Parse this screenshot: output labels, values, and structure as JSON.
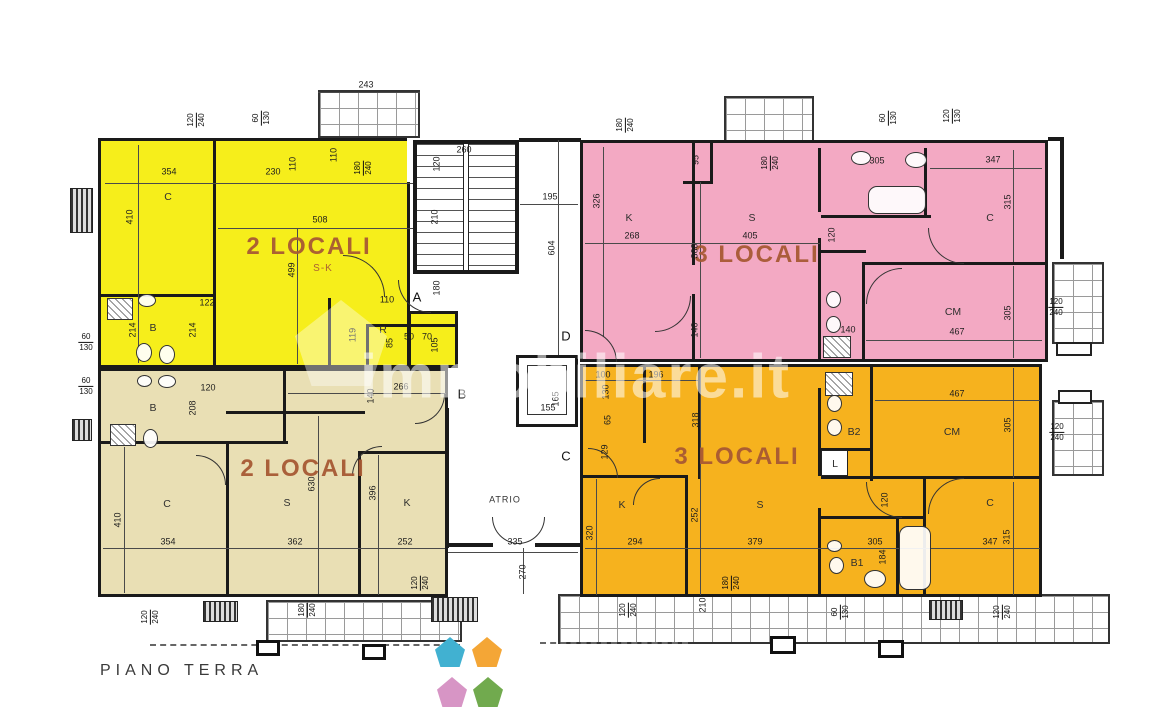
{
  "meta": {
    "floor_label": "PIANO TERRA",
    "watermark_text": "immobiliare.it"
  },
  "palette": {
    "yellow": "#f6ee1b",
    "pink": "#f3a9c3",
    "beige": "#e9dfb4",
    "orange": "#f6b21e",
    "wall": "#1a1a1a",
    "apt_text": "#a75834"
  },
  "apartments": [
    {
      "id": "apt-nw",
      "label": "2 LOCALI",
      "sublabel": "S-K",
      "color": "yellow"
    },
    {
      "id": "apt-ne",
      "label": "3 LOCALI",
      "color": "pink"
    },
    {
      "id": "apt-sw",
      "label": "2 LOCALI",
      "color": "beige"
    },
    {
      "id": "apt-se",
      "label": "3 LOCALI",
      "color": "orange"
    }
  ],
  "outlines": [
    [
      98,
      138,
      312,
      230
    ],
    [
      408,
      311,
      50,
      57
    ],
    [
      580,
      140,
      468,
      222
    ],
    [
      98,
      368,
      350,
      229
    ],
    [
      580,
      364,
      462,
      233
    ],
    [
      413,
      140,
      106,
      134
    ],
    [
      516,
      355,
      62,
      72
    ]
  ],
  "roomfills": [
    {
      "c": "yellow",
      "r": [
        101,
        141,
        306,
        224
      ]
    },
    {
      "c": "yellow",
      "r": [
        411,
        314,
        44,
        51
      ]
    },
    {
      "c": "pink",
      "r": [
        583,
        143,
        462,
        216
      ]
    },
    {
      "c": "beige",
      "r": [
        101,
        371,
        344,
        223
      ]
    },
    {
      "c": "orange",
      "r": [
        583,
        367,
        456,
        227
      ]
    }
  ],
  "whiteboxes": [
    [
      407,
      138,
      52,
      44
    ],
    [
      527,
      365,
      40,
      50
    ]
  ],
  "walls": [
    [
      213,
      141,
      3,
      157
    ],
    [
      101,
      294,
      114,
      3
    ],
    [
      213,
      294,
      3,
      74
    ],
    [
      328,
      298,
      3,
      70
    ],
    [
      366,
      324,
      92,
      3
    ],
    [
      366,
      324,
      3,
      44
    ],
    [
      692,
      143,
      3,
      122
    ],
    [
      692,
      294,
      3,
      66
    ],
    [
      710,
      143,
      3,
      40
    ],
    [
      683,
      181,
      30,
      3
    ],
    [
      818,
      148,
      3,
      64
    ],
    [
      818,
      238,
      3,
      122
    ],
    [
      821,
      215,
      110,
      3
    ],
    [
      924,
      148,
      3,
      70
    ],
    [
      864,
      262,
      181,
      3
    ],
    [
      862,
      262,
      3,
      98
    ],
    [
      821,
      250,
      45,
      3
    ],
    [
      101,
      441,
      187,
      3
    ],
    [
      283,
      371,
      3,
      73
    ],
    [
      226,
      443,
      3,
      152
    ],
    [
      226,
      411,
      139,
      3
    ],
    [
      358,
      451,
      3,
      144
    ],
    [
      358,
      451,
      90,
      3
    ],
    [
      445,
      408,
      4,
      140
    ],
    [
      445,
      543,
      48,
      4
    ],
    [
      535,
      543,
      47,
      4
    ],
    [
      643,
      367,
      3,
      76
    ],
    [
      698,
      367,
      3,
      112
    ],
    [
      583,
      475,
      105,
      3
    ],
    [
      685,
      477,
      3,
      120
    ],
    [
      818,
      388,
      3,
      88
    ],
    [
      818,
      508,
      3,
      89
    ],
    [
      870,
      367,
      3,
      114
    ],
    [
      821,
      476,
      221,
      3
    ],
    [
      923,
      479,
      3,
      118
    ],
    [
      821,
      516,
      104,
      3
    ],
    [
      821,
      448,
      51,
      3
    ],
    [
      896,
      519,
      3,
      78
    ],
    [
      519,
      138,
      62,
      4
    ],
    [
      1048,
      137,
      16,
      4
    ],
    [
      1060,
      137,
      4,
      122
    ]
  ],
  "balconies": [
    [
      318,
      90,
      102,
      48
    ],
    [
      724,
      96,
      90,
      62
    ],
    [
      1052,
      262,
      52,
      82
    ],
    [
      1052,
      400,
      52,
      76
    ],
    [
      266,
      600,
      196,
      42
    ],
    [
      558,
      594,
      552,
      50
    ]
  ],
  "flowerboxes": [
    [
      1056,
      342,
      36,
      14
    ],
    [
      1058,
      390,
      34,
      14
    ]
  ],
  "posts": [
    [
      256,
      640,
      24,
      16
    ],
    [
      362,
      644,
      24,
      16
    ],
    [
      770,
      636,
      26,
      18
    ],
    [
      878,
      640,
      26,
      18
    ]
  ],
  "radiators": [
    [
      70,
      188,
      23,
      45
    ],
    [
      72,
      419,
      20,
      22
    ],
    [
      203,
      601,
      35,
      21
    ],
    [
      431,
      597,
      47,
      25
    ],
    [
      929,
      600,
      34,
      20
    ]
  ],
  "dashes": [
    [
      150,
      644,
      310
    ],
    [
      540,
      642,
      148
    ]
  ],
  "dimlines": [
    [
      318,
      92,
      102,
      1
    ],
    [
      415,
      156,
      102,
      1
    ],
    [
      520,
      204,
      58,
      1
    ],
    [
      105,
      183,
      348,
      1
    ],
    [
      218,
      228,
      240,
      1
    ],
    [
      585,
      243,
      235,
      1
    ],
    [
      930,
      168,
      112,
      1
    ],
    [
      866,
      340,
      176,
      1
    ],
    [
      585,
      380,
      113,
      1
    ],
    [
      875,
      400,
      165,
      1
    ],
    [
      103,
      548,
      342,
      1
    ],
    [
      585,
      548,
      455,
      1
    ],
    [
      448,
      552,
      130,
      1
    ],
    [
      288,
      393,
      158,
      1
    ],
    [
      138,
      145,
      1,
      218
    ],
    [
      297,
      228,
      1,
      136
    ],
    [
      443,
      145,
      1,
      126
    ],
    [
      558,
      140,
      1,
      226
    ],
    [
      603,
      147,
      1,
      190
    ],
    [
      700,
      182,
      1,
      176
    ],
    [
      1013,
      150,
      1,
      112
    ],
    [
      1013,
      266,
      1,
      92
    ],
    [
      124,
      447,
      1,
      146
    ],
    [
      318,
      416,
      1,
      178
    ],
    [
      378,
      455,
      1,
      140
    ],
    [
      596,
      479,
      1,
      116
    ],
    [
      700,
      368,
      1,
      227
    ],
    [
      1013,
      368,
      1,
      110
    ],
    [
      1013,
      482,
      1,
      113
    ],
    [
      523,
      548,
      1,
      46
    ]
  ],
  "stairs": {
    "block": [
      413,
      140,
      106,
      134
    ],
    "stripes": [
      417,
      144,
      98,
      126
    ],
    "divider": [
      463,
      144,
      6,
      126
    ]
  },
  "elevator": {
    "outer": [
      516,
      355,
      62,
      72
    ],
    "inner": [
      527,
      365,
      40,
      50
    ]
  },
  "fixtures": {
    "showers": [
      [
        107,
        298,
        26,
        22
      ],
      [
        110,
        424,
        26,
        22
      ],
      [
        823,
        336,
        28,
        22
      ],
      [
        825,
        372,
        28,
        24
      ]
    ],
    "tubs": [
      [
        868,
        186,
        58,
        28
      ],
      [
        899,
        526,
        32,
        64
      ]
    ],
    "ellipses": [
      [
        138,
        294,
        18,
        13
      ],
      [
        136,
        343,
        16,
        19
      ],
      [
        159,
        345,
        16,
        19
      ],
      [
        137,
        375,
        15,
        12
      ],
      [
        158,
        375,
        18,
        13
      ],
      [
        143,
        429,
        15,
        19
      ],
      [
        851,
        151,
        20,
        14
      ],
      [
        905,
        152,
        22,
        16
      ],
      [
        826,
        291,
        15,
        17
      ],
      [
        826,
        316,
        15,
        17
      ],
      [
        827,
        395,
        15,
        17
      ],
      [
        827,
        419,
        15,
        17
      ],
      [
        827,
        540,
        15,
        12
      ],
      [
        829,
        557,
        15,
        17
      ],
      [
        864,
        570,
        22,
        18
      ]
    ],
    "boxes": [
      [
        821,
        450,
        27,
        26
      ]
    ]
  },
  "doors": [
    [
      343,
      255,
      42,
      "tr"
    ],
    [
      398,
      280,
      33,
      "bl"
    ],
    [
      655,
      296,
      36,
      "br"
    ],
    [
      585,
      330,
      32,
      "tr"
    ],
    [
      928,
      228,
      36,
      "bl"
    ],
    [
      866,
      268,
      36,
      "tl"
    ],
    [
      352,
      446,
      30,
      "tl"
    ],
    [
      196,
      455,
      30,
      "tr"
    ],
    [
      415,
      394,
      30,
      "br"
    ],
    [
      588,
      448,
      30,
      "tr"
    ],
    [
      633,
      478,
      27,
      "tl"
    ],
    [
      866,
      482,
      36,
      "bl"
    ],
    [
      928,
      478,
      36,
      "tl"
    ],
    [
      492,
      517,
      27,
      "bl"
    ],
    [
      518,
      517,
      27,
      "br"
    ]
  ],
  "labels": {
    "apt": [
      [
        "2 LOCALI",
        309,
        247
      ],
      [
        "3 LOCALI",
        757,
        255
      ],
      [
        "2 LOCALI",
        303,
        469
      ],
      [
        "3 LOCALI",
        737,
        457
      ]
    ],
    "sub": [
      [
        "S-K",
        323,
        269
      ]
    ],
    "room": [
      [
        "C",
        168,
        197
      ],
      [
        "B",
        153,
        328
      ],
      [
        "R",
        383,
        330
      ],
      [
        "K",
        629,
        218
      ],
      [
        "S",
        752,
        218
      ],
      [
        "C",
        990,
        218
      ],
      [
        "CM",
        953,
        312
      ],
      [
        "B",
        153,
        408
      ],
      [
        "C",
        167,
        504
      ],
      [
        "S",
        287,
        503
      ],
      [
        "K",
        407,
        503
      ],
      [
        "K",
        622,
        505
      ],
      [
        "S",
        760,
        505
      ],
      [
        "CM",
        952,
        432
      ],
      [
        "C",
        990,
        503
      ],
      [
        "B2",
        854,
        432
      ],
      [
        "B1",
        857,
        563
      ],
      [
        "L",
        835,
        464
      ]
    ],
    "atrio": [
      [
        "ATRIO",
        505,
        500
      ]
    ],
    "letter": [
      [
        "A",
        417,
        297
      ],
      [
        "B",
        462,
        394
      ],
      [
        "C",
        566,
        456
      ],
      [
        "D",
        566,
        336
      ]
    ],
    "dim": [
      [
        "354",
        169,
        172
      ],
      [
        "230",
        273,
        172
      ],
      [
        "508",
        320,
        220
      ],
      [
        "122",
        207,
        303
      ],
      [
        "110",
        387,
        300
      ],
      [
        "50",
        409,
        337
      ],
      [
        "70",
        427,
        337
      ],
      [
        "243",
        366,
        85
      ],
      [
        "260",
        464,
        150
      ],
      [
        "195",
        550,
        197
      ],
      [
        "268",
        632,
        236
      ],
      [
        "405",
        750,
        236
      ],
      [
        "305",
        877,
        161
      ],
      [
        "347",
        993,
        160
      ],
      [
        "467",
        957,
        332
      ],
      [
        "140",
        848,
        330
      ],
      [
        "120",
        208,
        388
      ],
      [
        "266",
        401,
        387
      ],
      [
        "354",
        168,
        542
      ],
      [
        "362",
        295,
        542
      ],
      [
        "252",
        405,
        542
      ],
      [
        "100",
        603,
        375
      ],
      [
        "196",
        656,
        375
      ],
      [
        "294",
        635,
        542
      ],
      [
        "379",
        755,
        542
      ],
      [
        "305",
        875,
        542
      ],
      [
        "467",
        957,
        394
      ],
      [
        "347",
        990,
        542
      ],
      [
        "335",
        515,
        542
      ],
      [
        "155",
        548,
        408
      ]
    ],
    "dimv": [
      [
        "410",
        130,
        217
      ],
      [
        "110",
        293,
        164
      ],
      [
        "110",
        334,
        155
      ],
      [
        "499",
        292,
        270
      ],
      [
        "214",
        133,
        330
      ],
      [
        "214",
        193,
        330
      ],
      [
        "119",
        353,
        335
      ],
      [
        "105",
        435,
        345
      ],
      [
        "85",
        390,
        343
      ],
      [
        "120",
        437,
        164
      ],
      [
        "210",
        435,
        217
      ],
      [
        "180",
        437,
        288
      ],
      [
        "604",
        552,
        248
      ],
      [
        "326",
        597,
        201
      ],
      [
        "95",
        696,
        160
      ],
      [
        "360",
        695,
        251
      ],
      [
        "140",
        695,
        330
      ],
      [
        "315",
        1008,
        202
      ],
      [
        "120",
        832,
        235
      ],
      [
        "305",
        1008,
        313
      ],
      [
        "208",
        193,
        408
      ],
      [
        "410",
        118,
        520
      ],
      [
        "630",
        312,
        484
      ],
      [
        "396",
        373,
        493
      ],
      [
        "140",
        371,
        396
      ],
      [
        "318",
        696,
        420
      ],
      [
        "130",
        606,
        392
      ],
      [
        "65",
        608,
        420
      ],
      [
        "129",
        605,
        452
      ],
      [
        "320",
        590,
        533
      ],
      [
        "252",
        695,
        515
      ],
      [
        "120",
        885,
        500
      ],
      [
        "184",
        883,
        557
      ],
      [
        "305",
        1008,
        425
      ],
      [
        "315",
        1007,
        537
      ],
      [
        "165",
        556,
        399
      ],
      [
        "270",
        523,
        572
      ],
      [
        "210",
        703,
        605
      ]
    ]
  },
  "fracs": [
    [
      "120",
      "240",
      196,
      120,
      1
    ],
    [
      "60",
      "130",
      261,
      118,
      1
    ],
    [
      "180",
      "240",
      363,
      168,
      1
    ],
    [
      "180",
      "240",
      625,
      125,
      1
    ],
    [
      "180",
      "240",
      770,
      163,
      1
    ],
    [
      "60",
      "130",
      888,
      118,
      1
    ],
    [
      "120",
      "130",
      952,
      116,
      1
    ],
    [
      "60",
      "130",
      86,
      342,
      0
    ],
    [
      "60",
      "130",
      86,
      386,
      0
    ],
    [
      "120",
      "240",
      1056,
      307,
      0
    ],
    [
      "120",
      "240",
      1057,
      432,
      0
    ],
    [
      "120",
      "240",
      150,
      617,
      1
    ],
    [
      "180",
      "240",
      307,
      610,
      1
    ],
    [
      "120",
      "240",
      420,
      583,
      1
    ],
    [
      "120",
      "240",
      628,
      610,
      1
    ],
    [
      "180",
      "240",
      731,
      583,
      1
    ],
    [
      "60",
      "130",
      840,
      612,
      1
    ],
    [
      "120",
      "240",
      1002,
      612,
      1
    ]
  ],
  "logo": {
    "houses": [
      {
        "name": "logo-house-teal",
        "color": "#41b1d1",
        "x": 435,
        "y": 637
      },
      {
        "name": "logo-house-orange",
        "color": "#f4a636",
        "x": 472,
        "y": 637
      },
      {
        "name": "logo-house-pink",
        "color": "#d795c5",
        "x": 437,
        "y": 677
      },
      {
        "name": "logo-house-green",
        "color": "#71aa4e",
        "x": 473,
        "y": 677
      }
    ],
    "size": 30
  },
  "ghost_house": [
    295,
    300,
    92,
    86
  ],
  "floor_label_pos": [
    100,
    662
  ]
}
